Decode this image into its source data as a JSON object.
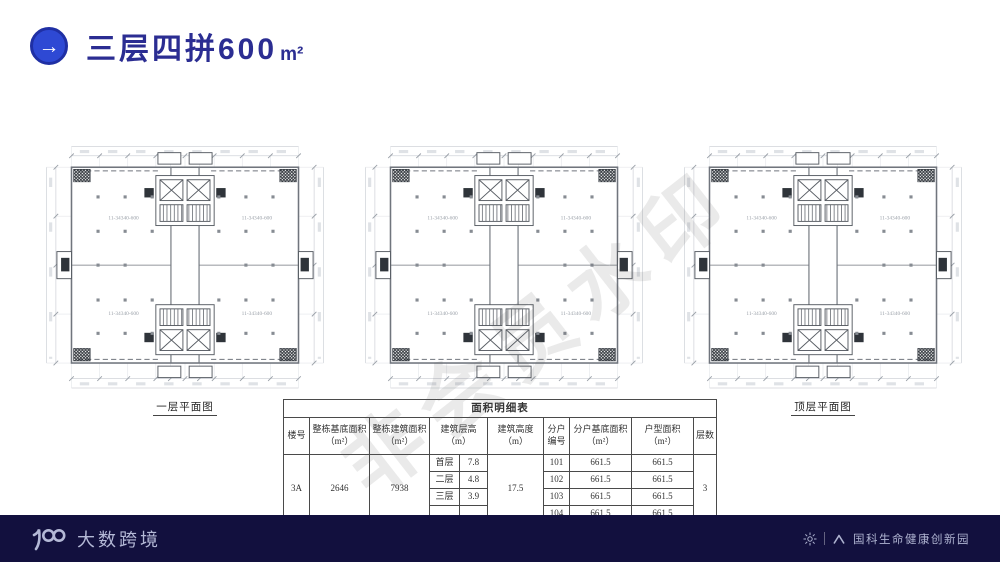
{
  "header": {
    "title": "三层四拼600",
    "title_unit": "m²",
    "accent_color": "#2e49d4",
    "title_color": "#2b2d92"
  },
  "watermark": {
    "text": "非会员水印"
  },
  "plans": [
    {
      "caption": "一层平面图"
    },
    {
      "caption": "二层平面图"
    },
    {
      "caption": "顶层平面图"
    }
  ],
  "floorplan": {
    "room_label": "11-34340-600"
  },
  "area_table": {
    "title": "面积明细表",
    "headers": {
      "building_no": "楼号",
      "base_area": "整栋基底面积（m²）",
      "gross_floor_area": "整栋建筑面积（m²）",
      "storey_height": "建筑层高（m）",
      "building_height": "建筑高度（m）",
      "unit_no": "分户编号",
      "unit_base_area": "分户基底面积（m²）",
      "unit_area": "户型面积（m²）",
      "floors": "层数"
    },
    "building_no": "3A",
    "base_area": "2646",
    "gross_floor_area": "7938",
    "storey_heights": [
      {
        "floor": "首层",
        "h": "7.8"
      },
      {
        "floor": "二层",
        "h": "4.8"
      },
      {
        "floor": "三层",
        "h": "3.9"
      },
      {
        "floor": "",
        "h": ""
      }
    ],
    "building_height": "17.5",
    "units": [
      {
        "no": "101",
        "base": "661.5",
        "area": "661.5"
      },
      {
        "no": "102",
        "base": "661.5",
        "area": "661.5"
      },
      {
        "no": "103",
        "base": "661.5",
        "area": "661.5"
      },
      {
        "no": "104",
        "base": "661.5",
        "area": "661.5"
      }
    ],
    "floors": "3"
  },
  "footer": {
    "brand": "大数跨境",
    "park_name": "国科生命健康创新园",
    "bg_color": "#12103e"
  }
}
